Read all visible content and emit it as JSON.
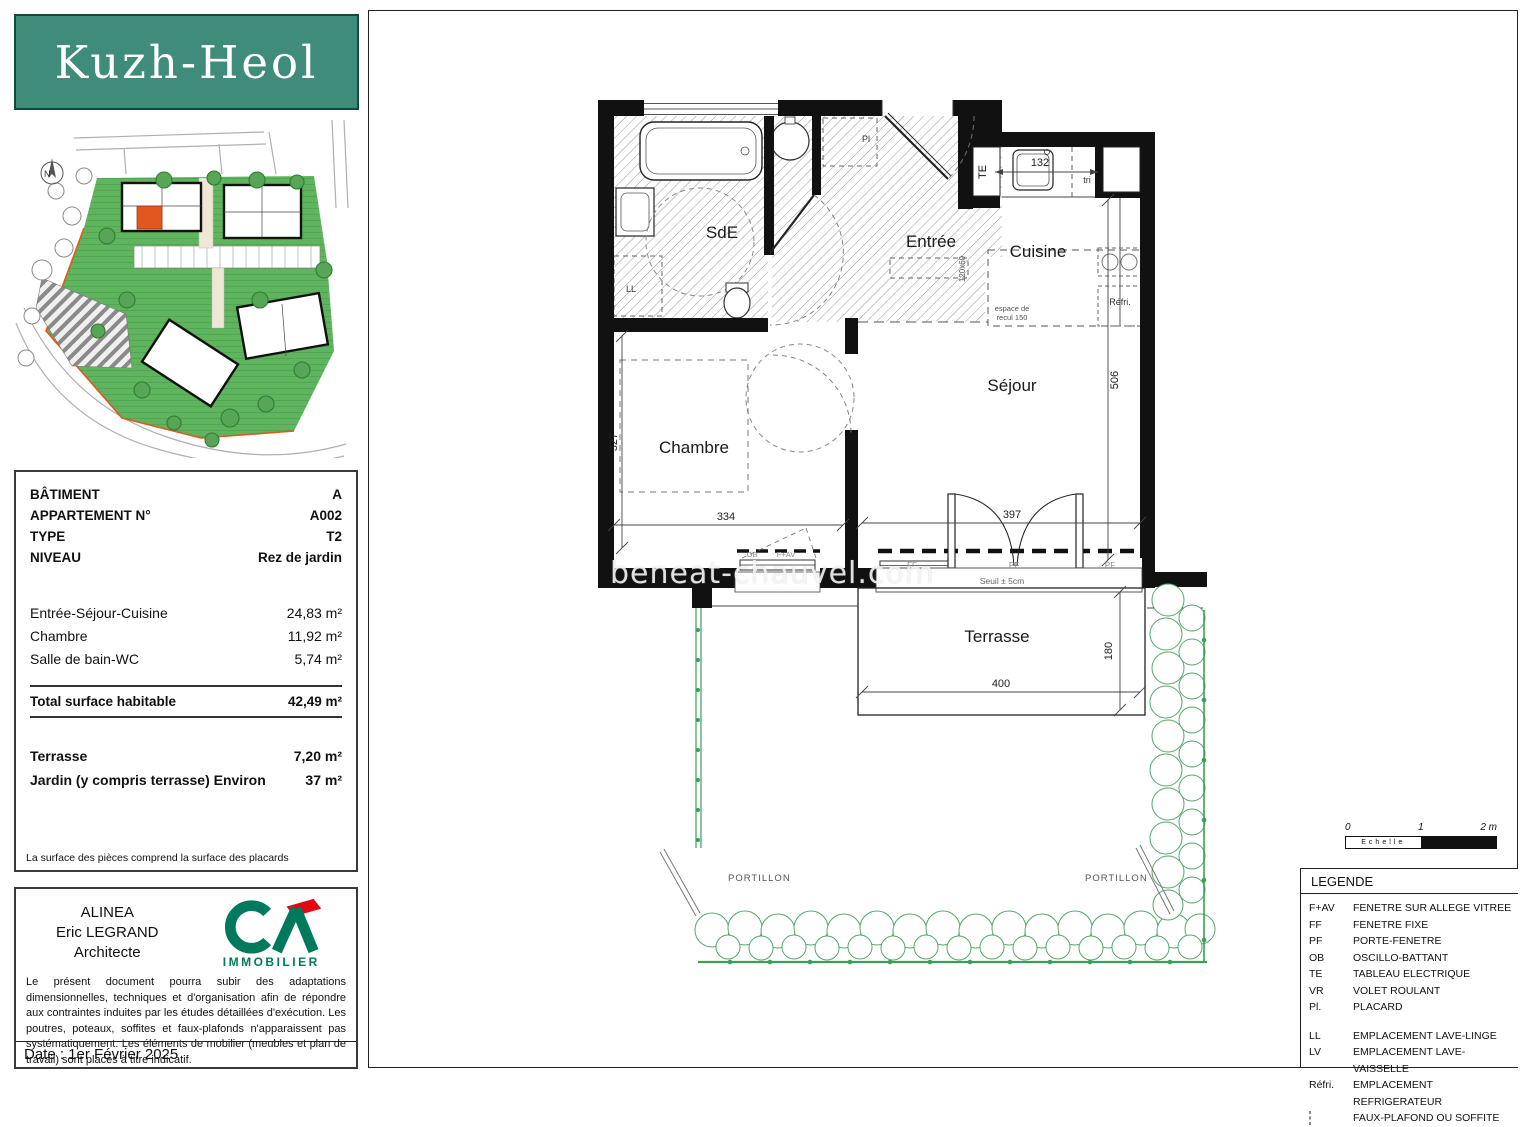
{
  "header": {
    "logo": "Kuzh-Heol"
  },
  "site_plan": {
    "north": "N"
  },
  "info": {
    "rows": [
      {
        "label": "BÂTIMENT",
        "value": "A"
      },
      {
        "label": "APPARTEMENT N°",
        "value": "A002"
      },
      {
        "label": "TYPE",
        "value": "T2"
      },
      {
        "label": "NIVEAU",
        "value": "Rez de jardin"
      }
    ],
    "surfaces": [
      {
        "label": "Entrée-Séjour-Cuisine",
        "value": "24,83 m²"
      },
      {
        "label": "Chambre",
        "value": "11,92 m²"
      },
      {
        "label": "Salle de bain-WC",
        "value": "5,74 m²"
      }
    ],
    "total": {
      "label": "Total surface habitable",
      "value": "42,49 m²"
    },
    "outdoor": [
      {
        "label": "Terrasse",
        "value": "7,20 m²"
      },
      {
        "label": "Jardin (y compris terrasse) Environ",
        "value": "37 m²"
      }
    ],
    "note": "La surface des pièces comprend la surface des placards"
  },
  "architect": {
    "line1": "ALINEA",
    "line2": "Eric LEGRAND",
    "line3": "Architecte",
    "logo_sub": "IMMOBILIER",
    "disclaimer": "Le présent document pourra subir des adaptations dimensionnelles, techniques et d'organisation afin de répondre aux contraintes induites par les études détaillées d'exécution. Les poutres, poteaux, soffites et faux-plafonds n'apparaissent pas systématiquement. Les éléments de mobilier (meubles et plan de travail) sont placés à titre indicatif.",
    "date": "Date : 1er Février 2025"
  },
  "plan": {
    "rooms": {
      "sde": "SdE",
      "entree": "Entrée",
      "cuisine": "Cuisine",
      "sejour": "Séjour",
      "chambre": "Chambre",
      "terrasse": "Terrasse"
    },
    "dims": {
      "d132": "132",
      "d506": "506",
      "d397": "397",
      "d334": "334",
      "d327": "327",
      "d400": "400",
      "d180": "180",
      "placard": "120x60"
    },
    "annotations": {
      "tri": "tri",
      "te": "TE",
      "pl": "Pl",
      "ll": "LL",
      "refri": "Réfri.",
      "espace_1": "espace de",
      "espace_2": "recul 150",
      "seuil": "Seuil ± 5cm",
      "ff": "FF",
      "pf": "PF",
      "fav": "F+AV",
      "ob": "OB",
      "portillon": "PORTILLON"
    }
  },
  "legend": {
    "title": "LEGENDE",
    "items": [
      {
        "abbr": "F+AV",
        "desc": "FENETRE SUR ALLEGE VITREE"
      },
      {
        "abbr": "FF",
        "desc": "FENETRE FIXE"
      },
      {
        "abbr": "PF",
        "desc": "PORTE-FENETRE"
      },
      {
        "abbr": "OB",
        "desc": "OSCILLO-BATTANT"
      },
      {
        "abbr": "TE",
        "desc": "TABLEAU ELECTRIQUE"
      },
      {
        "abbr": "VR",
        "desc": "VOLET ROULANT"
      },
      {
        "abbr": "Pl.",
        "desc": "PLACARD"
      }
    ],
    "items2": [
      {
        "abbr": "LL",
        "desc": "EMPLACEMENT LAVE-LINGE"
      },
      {
        "abbr": "LV",
        "desc": "EMPLACEMENT LAVE-VAISSELLE"
      },
      {
        "abbr": "Réfri.",
        "desc": "EMPLACEMENT REFRIGERATEUR"
      },
      {
        "abbr": "",
        "desc": "FAUX-PLAFOND OU SOFFITE"
      }
    ]
  },
  "scalebar": {
    "t0": "0",
    "t1": "1",
    "t2": "2 m",
    "label": "Echelle"
  },
  "watermark": "beneat-chauvel.com",
  "colors": {
    "teal": "#3E8C79",
    "site_green": "#5FB45E",
    "unit_orange": "#E2571F",
    "hedge_green": "#55A86C",
    "fence_green": "#37A05A",
    "ca_green": "#00795C",
    "ca_red": "#E30613"
  }
}
